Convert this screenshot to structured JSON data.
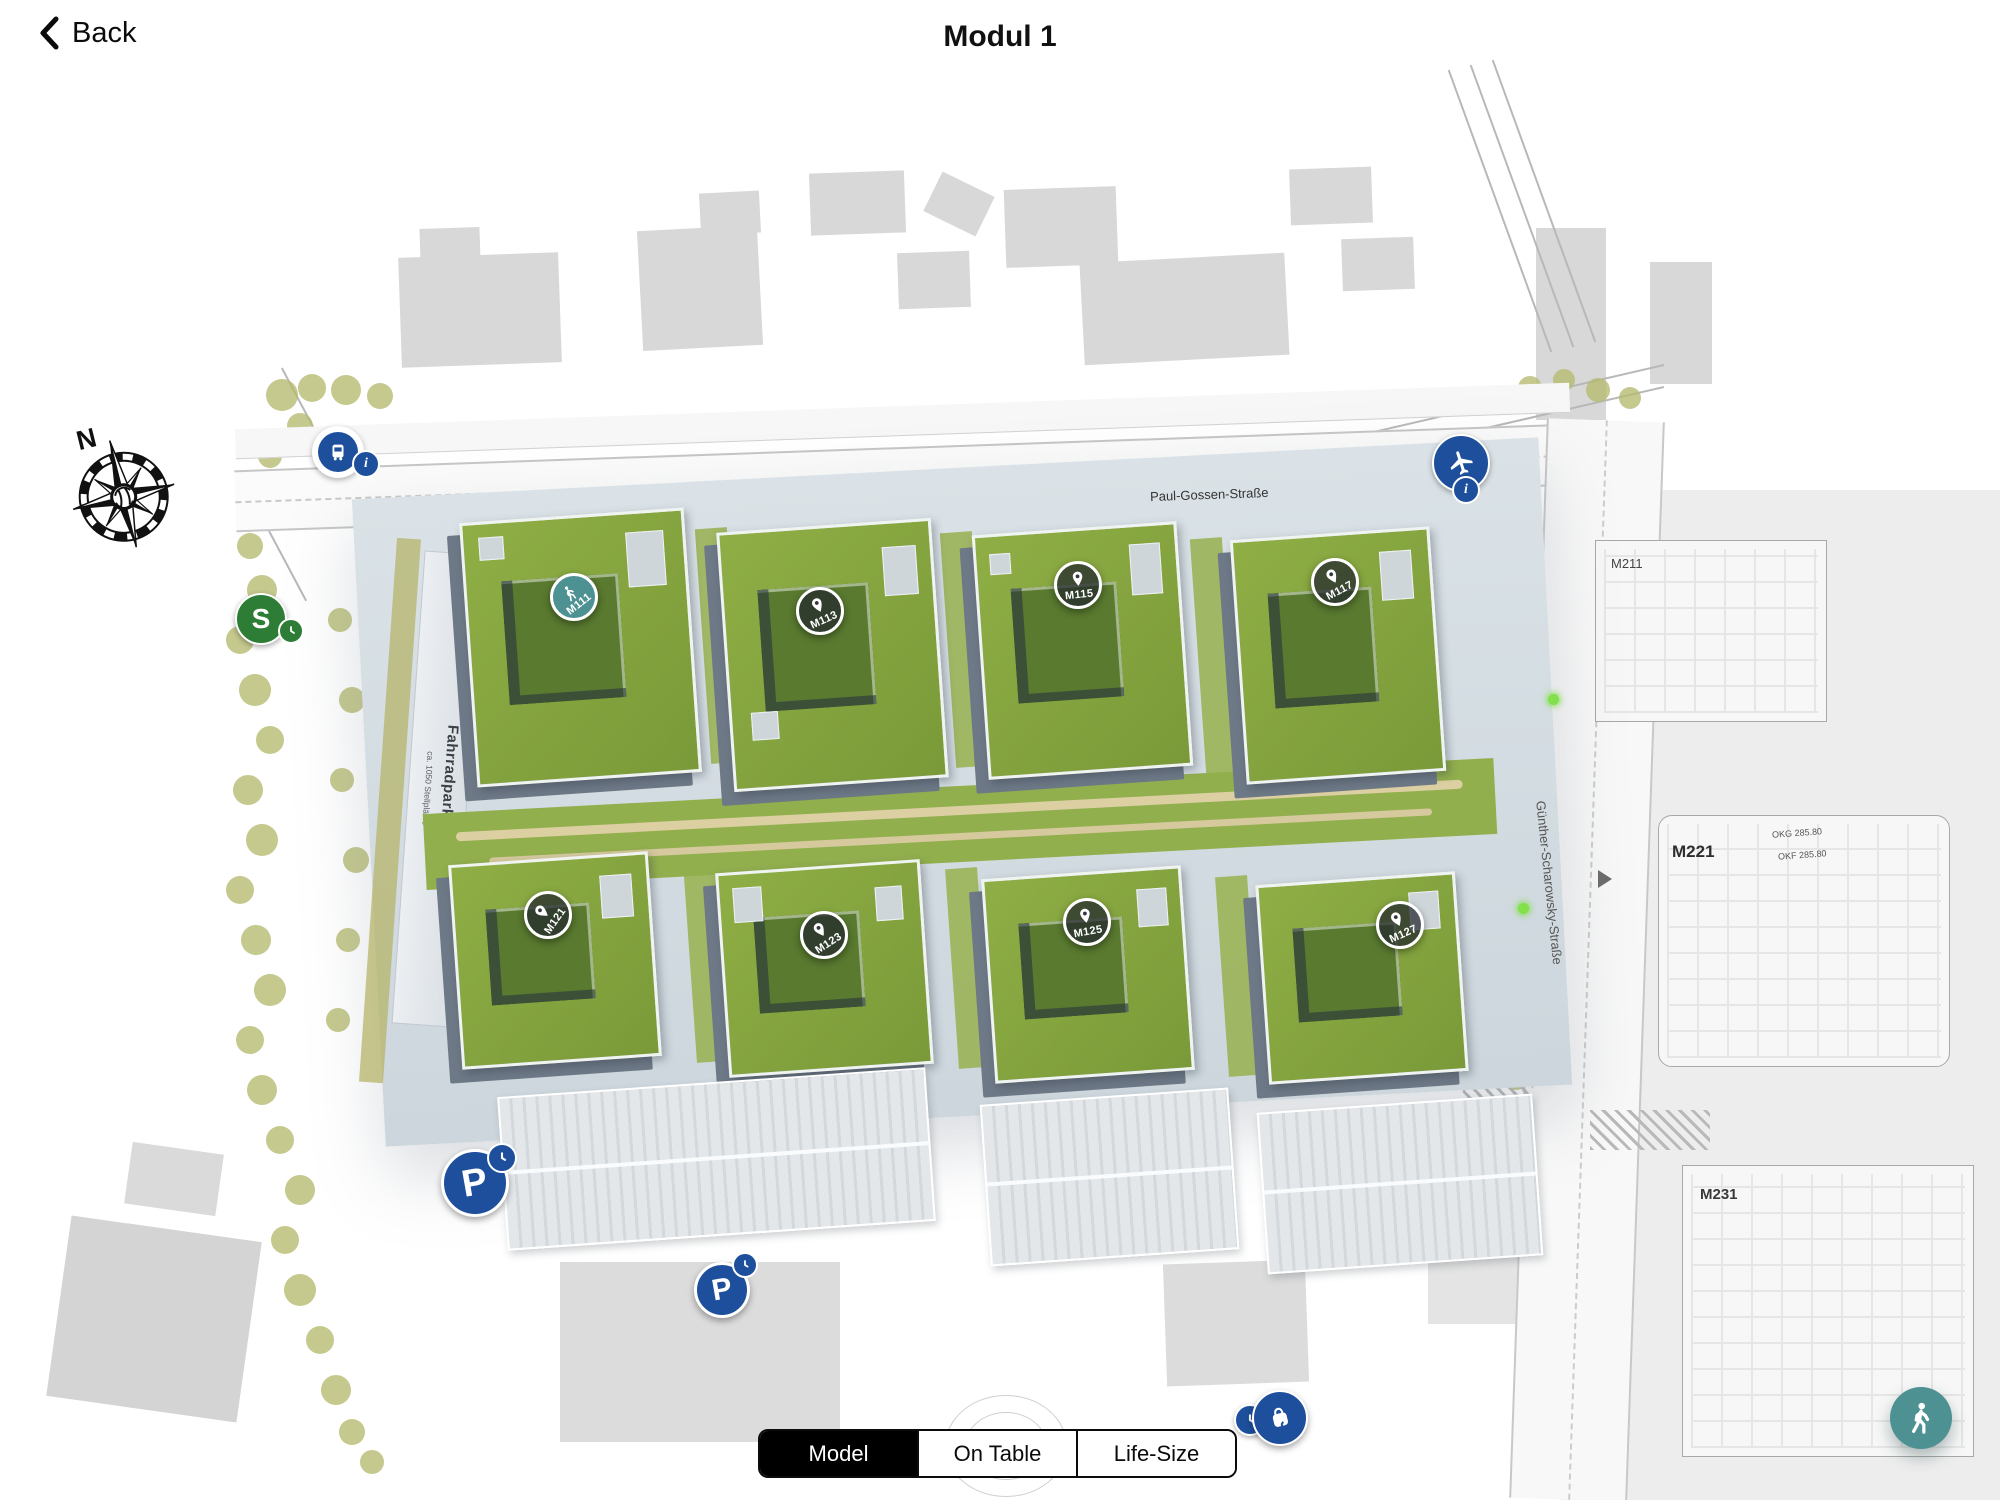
{
  "header": {
    "back_label": "Back",
    "title": "Modul 1"
  },
  "view_switcher": {
    "options": [
      {
        "label": "Model",
        "active": true
      },
      {
        "label": "On Table",
        "active": false
      },
      {
        "label": "Life-Size",
        "active": false
      }
    ]
  },
  "fab": {
    "icon": "pedestrian-walk-icon"
  },
  "colors": {
    "teal": "#4e9193",
    "marker_dark": "#23282e",
    "transit_blue": "#1d4f9c",
    "sbahn_green": "#2e7d36",
    "roof_green": "#85a43f",
    "court_green": "#597a2f",
    "park_green": "#92af4e",
    "olive": "#b5ba6e",
    "paving": "#d3dce2",
    "facade": "#6e7987",
    "footprint_gray": "#d8d8d8"
  },
  "map": {
    "streets": [
      {
        "name": "Paul-Gossen-Straße"
      },
      {
        "name": "Günther-Scharowsky-Straße"
      }
    ],
    "compass": {
      "label": "N"
    },
    "sbahn": {
      "label": "S"
    },
    "parking": [
      {
        "label": "P"
      },
      {
        "label": "P"
      }
    ],
    "info_badge": "i",
    "site_labels": [
      {
        "label": "Fahrradparkhaus",
        "sub": "ca. 1050 Stellplätze"
      }
    ],
    "plan_labels": [
      {
        "label": "M211",
        "notes": []
      },
      {
        "label": "M221",
        "notes": [
          "OKG 285.80",
          "OKF 285.80"
        ]
      },
      {
        "label": "M231",
        "notes": []
      }
    ],
    "markers": [
      {
        "label": "M111",
        "icon": "walk-icon",
        "variant": "teal",
        "x": 574,
        "y": 597,
        "label_rotation": -38
      },
      {
        "label": "M113",
        "icon": "pin-icon",
        "variant": "dark",
        "x": 820,
        "y": 611,
        "label_rotation": -24
      },
      {
        "label": "M115",
        "icon": "pin-icon",
        "variant": "dark",
        "x": 1078,
        "y": 585,
        "label_rotation": -6
      },
      {
        "label": "M117",
        "icon": "pin-icon",
        "variant": "dark",
        "x": 1335,
        "y": 582,
        "label_rotation": -28
      },
      {
        "label": "M121",
        "icon": "pin-icon",
        "variant": "dark",
        "x": 548,
        "y": 915,
        "label_rotation": -55
      },
      {
        "label": "M123",
        "icon": "pin-icon",
        "variant": "dark",
        "x": 824,
        "y": 935,
        "label_rotation": -33
      },
      {
        "label": "M125",
        "icon": "pin-icon",
        "variant": "dark",
        "x": 1087,
        "y": 922,
        "label_rotation": -10
      },
      {
        "label": "M127",
        "icon": "pin-icon",
        "variant": "dark",
        "x": 1400,
        "y": 925,
        "label_rotation": -24
      }
    ]
  }
}
